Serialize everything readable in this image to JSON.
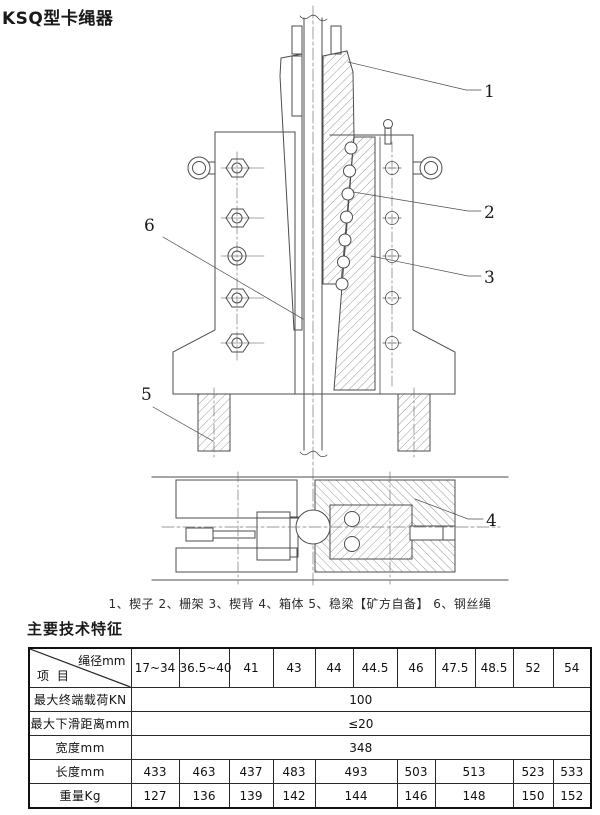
{
  "page": {
    "title": "KSQ型卡绳器",
    "parts_caption": "1、楔子 2、栅架 3、楔背 4、箱体 5、稳梁【矿方自备】 6、钢丝绳",
    "section_heading": "主要技术特征"
  },
  "diagram": {
    "callouts": [
      "1",
      "2",
      "3",
      "4",
      "5",
      "6"
    ],
    "line_color": "#4d4d4d",
    "hatch_color": "#8f8f8f"
  },
  "table": {
    "corner": {
      "top_right": "绳径mm",
      "bottom_left": "项 目"
    },
    "columns": [
      "17~34",
      "36.5~40",
      "41",
      "43",
      "44",
      "44.5",
      "46",
      "47.5",
      "48.5",
      "52",
      "54"
    ],
    "rows": [
      {
        "label": "最大终端载荷KN",
        "value": "100"
      },
      {
        "label": "最大下滑距离mm",
        "value": "≤20"
      },
      {
        "label": "宽度mm",
        "value": "348"
      },
      {
        "label": "长度mm",
        "cells": [
          {
            "v": "433",
            "span": "1"
          },
          {
            "v": "463",
            "span": "1"
          },
          {
            "v": "437",
            "span": "1"
          },
          {
            "v": "483",
            "span": "1"
          },
          {
            "v": "493",
            "span": "2"
          },
          {
            "v": "503",
            "span": "1"
          },
          {
            "v": "513",
            "span": "2"
          },
          {
            "v": "523",
            "span": "1"
          },
          {
            "v": "533",
            "span": "1"
          }
        ]
      },
      {
        "label": "重量Kg",
        "cells": [
          {
            "v": "127",
            "span": "1"
          },
          {
            "v": "136",
            "span": "1"
          },
          {
            "v": "139",
            "span": "1"
          },
          {
            "v": "142",
            "span": "1"
          },
          {
            "v": "144",
            "span": "2"
          },
          {
            "v": "146",
            "span": "1"
          },
          {
            "v": "148",
            "span": "2"
          },
          {
            "v": "150",
            "span": "1"
          },
          {
            "v": "152",
            "span": "1"
          }
        ]
      }
    ]
  }
}
